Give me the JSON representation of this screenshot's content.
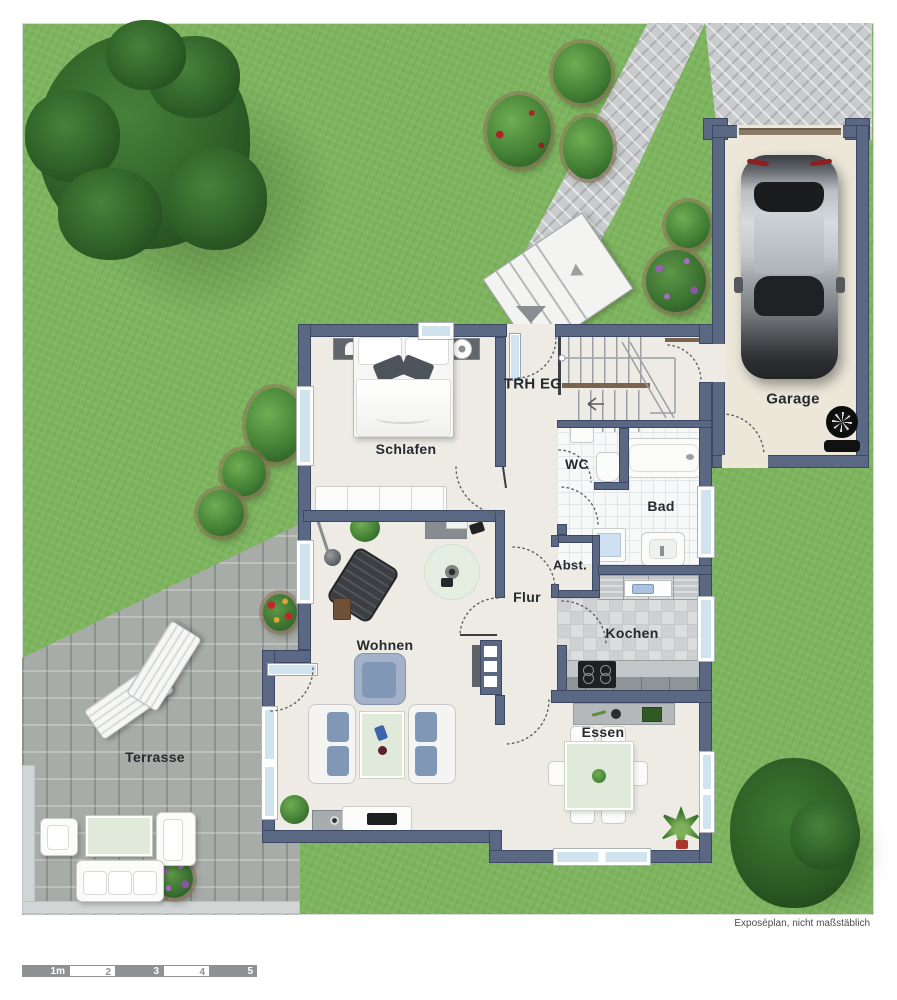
{
  "rooms": [
    {
      "id": "schlafen",
      "label": "Schlafen"
    },
    {
      "id": "trh_eg",
      "label": "TRH EG"
    },
    {
      "id": "wc",
      "label": "WC"
    },
    {
      "id": "bad",
      "label": "Bad"
    },
    {
      "id": "abst",
      "label": "Abst."
    },
    {
      "id": "flur",
      "label": "Flur"
    },
    {
      "id": "wohnen",
      "label": "Wohnen"
    },
    {
      "id": "kochen",
      "label": "Kochen"
    },
    {
      "id": "essen",
      "label": "Essen"
    },
    {
      "id": "terrasse",
      "label": "Terrasse"
    },
    {
      "id": "garage",
      "label": "Garage"
    }
  ],
  "footer": {
    "disclaimer": "Exposéplan, nicht maßstäblich"
  },
  "scalebar": {
    "segments": [
      {
        "label": "1m",
        "filled": true
      },
      {
        "label": "2",
        "filled": false
      },
      {
        "label": "3",
        "filled": true
      },
      {
        "label": "4",
        "filled": false
      },
      {
        "label": "5",
        "filled": true
      }
    ]
  },
  "colors": {
    "lawn": "#7db45e",
    "wall": "#5a6884",
    "floor": "#edebe4",
    "paving": "#c9cbcd",
    "terrace": "#a8aca9",
    "garage_floor": "#ece7d9",
    "glass": "#cfe4ef",
    "table_green": "#dfeadb",
    "sofa_blue": "#8097b5"
  }
}
